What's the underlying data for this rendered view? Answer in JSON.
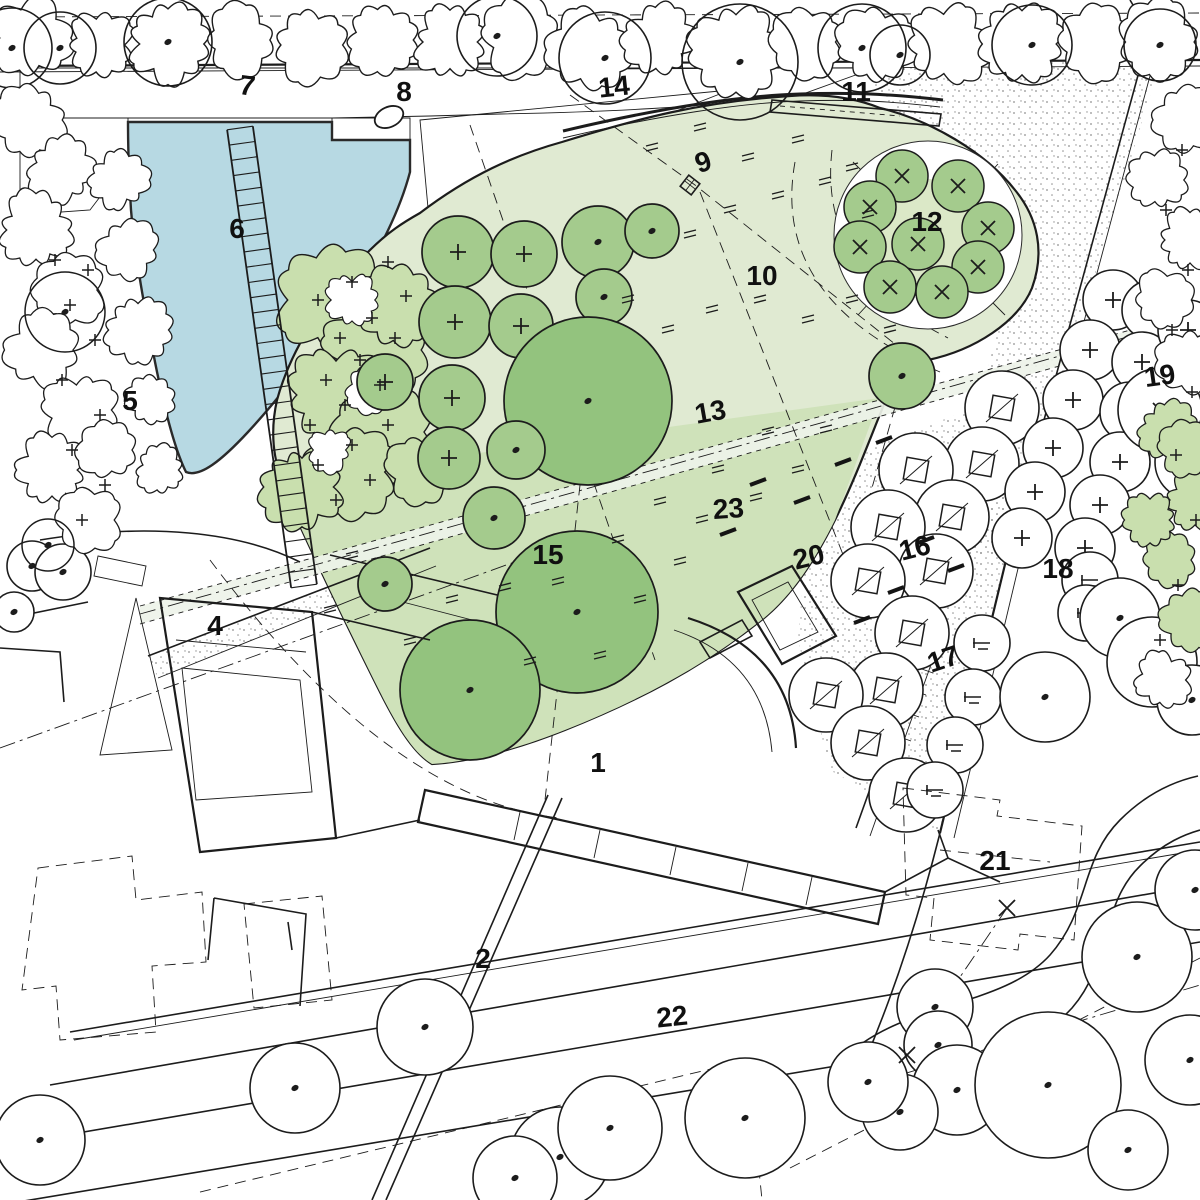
{
  "plan_title": "Landscape site plan",
  "colors": {
    "line": "#1c1c1c",
    "pond": "#b7d9e3",
    "lawn": "#e0ead2",
    "lawn_dark": "#cfe2ba",
    "path_band": "#eef3e9",
    "tree_green": "#a4cb8d",
    "tree_green_dark": "#93c37e",
    "grove_inner": "#dbe8c7",
    "shrub_green": "#c9dfae",
    "paper": "#ffffff",
    "label": "#101010"
  },
  "labels": [
    {
      "t": "1",
      "x": 598,
      "y": 772,
      "r": 0
    },
    {
      "t": "2",
      "x": 483,
      "y": 968,
      "r": 0
    },
    {
      "t": "4",
      "x": 215,
      "y": 635,
      "r": 0
    },
    {
      "t": "5",
      "x": 130,
      "y": 410,
      "r": 0
    },
    {
      "t": "6",
      "x": 237,
      "y": 238,
      "r": 0
    },
    {
      "t": "7",
      "x": 246,
      "y": 95,
      "r": 8
    },
    {
      "t": "8",
      "x": 404,
      "y": 101,
      "r": 0
    },
    {
      "t": "9",
      "x": 706,
      "y": 171,
      "r": -18
    },
    {
      "t": "10",
      "x": 762,
      "y": 285,
      "r": 0
    },
    {
      "t": "11",
      "x": 856,
      "y": 101,
      "r": 0
    },
    {
      "t": "12",
      "x": 927,
      "y": 231,
      "r": 0
    },
    {
      "t": "13",
      "x": 712,
      "y": 421,
      "r": -10
    },
    {
      "t": "14",
      "x": 615,
      "y": 96,
      "r": -6
    },
    {
      "t": "15",
      "x": 548,
      "y": 564,
      "r": 0
    },
    {
      "t": "16",
      "x": 917,
      "y": 557,
      "r": -14
    },
    {
      "t": "17",
      "x": 946,
      "y": 668,
      "r": -18
    },
    {
      "t": "18",
      "x": 1058,
      "y": 578,
      "r": 0
    },
    {
      "t": "19",
      "x": 1161,
      "y": 385,
      "r": -8
    },
    {
      "t": "20",
      "x": 811,
      "y": 566,
      "r": -14
    },
    {
      "t": "21",
      "x": 995,
      "y": 870,
      "r": 0
    },
    {
      "t": "22",
      "x": 673,
      "y": 1026,
      "r": -6
    },
    {
      "t": "23",
      "x": 729,
      "y": 518,
      "r": -4
    }
  ],
  "lawn_trees": [
    [
      458,
      252,
      36,
      "plus"
    ],
    [
      524,
      254,
      33,
      "plus"
    ],
    [
      598,
      242,
      36,
      "dot"
    ],
    [
      652,
      231,
      27,
      "dot"
    ],
    [
      455,
      322,
      36,
      "plus"
    ],
    [
      521,
      326,
      32,
      "plus"
    ],
    [
      604,
      297,
      28,
      "dot"
    ],
    [
      385,
      382,
      28,
      "plus"
    ],
    [
      452,
      398,
      33,
      "plus"
    ],
    [
      588,
      401,
      84,
      "dot"
    ],
    [
      449,
      458,
      31,
      "plus"
    ],
    [
      516,
      450,
      29,
      "dot"
    ],
    [
      494,
      518,
      31,
      "dot"
    ],
    [
      385,
      584,
      27,
      "dot"
    ],
    [
      577,
      612,
      81,
      "dot"
    ],
    [
      470,
      690,
      70,
      "dot"
    ],
    [
      902,
      376,
      33,
      "dot"
    ]
  ],
  "grove_trees": [
    [
      902,
      176
    ],
    [
      958,
      186
    ],
    [
      870,
      207
    ],
    [
      988,
      228
    ],
    [
      860,
      247
    ],
    [
      918,
      244
    ],
    [
      978,
      267
    ],
    [
      890,
      287
    ],
    [
      942,
      292
    ]
  ],
  "bosque_trees": [
    [
      1002,
      408
    ],
    [
      982,
      464
    ],
    [
      916,
      470
    ],
    [
      952,
      517
    ],
    [
      888,
      527
    ],
    [
      936,
      571
    ],
    [
      868,
      581
    ],
    [
      912,
      633
    ],
    [
      886,
      690
    ],
    [
      826,
      695
    ],
    [
      868,
      743
    ],
    [
      906,
      795
    ]
  ],
  "plaza_trees": [
    [
      1113,
      300
    ],
    [
      1152,
      310
    ],
    [
      1090,
      350
    ],
    [
      1142,
      362
    ],
    [
      1188,
      330
    ],
    [
      1073,
      400
    ],
    [
      1130,
      412
    ],
    [
      1190,
      372
    ],
    [
      1053,
      448
    ],
    [
      1120,
      462
    ],
    [
      1035,
      492
    ],
    [
      1100,
      505
    ],
    [
      1022,
      538
    ],
    [
      1085,
      548
    ]
  ],
  "dashed_trees": [
    [
      982,
      643
    ],
    [
      973,
      697
    ],
    [
      955,
      745
    ],
    [
      1090,
      580
    ],
    [
      1086,
      613
    ],
    [
      935,
      790
    ]
  ],
  "right_trees": [
    [
      1160,
      410,
      42,
      "x"
    ],
    [
      1193,
      462,
      38,
      "dot"
    ],
    [
      1120,
      618,
      40,
      "dot"
    ],
    [
      1152,
      662,
      45,
      "dot"
    ],
    [
      1045,
      697,
      45,
      "dot"
    ],
    [
      1192,
      700,
      35,
      "dot"
    ]
  ],
  "bottom_trees": [
    [
      425,
      1027,
      48
    ],
    [
      295,
      1088,
      45
    ],
    [
      40,
      1140,
      45
    ],
    [
      935,
      1007,
      38
    ],
    [
      938,
      1045,
      34
    ],
    [
      957,
      1090,
      45
    ],
    [
      900,
      1112,
      38
    ],
    [
      1048,
      1085,
      73
    ],
    [
      1137,
      957,
      55
    ],
    [
      560,
      1157,
      50
    ],
    [
      515,
      1178,
      42
    ],
    [
      610,
      1128,
      52
    ],
    [
      745,
      1118,
      60
    ],
    [
      868,
      1082,
      40
    ],
    [
      1128,
      1150,
      40
    ],
    [
      1195,
      890,
      40
    ],
    [
      32,
      566,
      25
    ],
    [
      63,
      572,
      28
    ],
    [
      14,
      612,
      20
    ],
    [
      1190,
      1060,
      45
    ]
  ],
  "band_blobs": [
    [
      30,
      38,
      40,
      1
    ],
    [
      100,
      45,
      34,
      2
    ],
    [
      168,
      44,
      40,
      3
    ],
    [
      240,
      40,
      36,
      4
    ],
    [
      310,
      45,
      38,
      5
    ],
    [
      382,
      40,
      34,
      6
    ],
    [
      450,
      42,
      36,
      7
    ],
    [
      520,
      38,
      40,
      8
    ],
    [
      590,
      50,
      42,
      9
    ],
    [
      660,
      40,
      36,
      10
    ],
    [
      736,
      50,
      44,
      11
    ],
    [
      808,
      42,
      36,
      12
    ],
    [
      876,
      46,
      40,
      13
    ],
    [
      948,
      45,
      40,
      14
    ],
    [
      1022,
      44,
      40,
      15
    ],
    [
      1095,
      42,
      38,
      16
    ],
    [
      1160,
      42,
      40,
      17
    ]
  ],
  "band_circles": [
    [
      12,
      48,
      40
    ],
    [
      60,
      48,
      36
    ],
    [
      168,
      42,
      44
    ],
    [
      497,
      36,
      40
    ],
    [
      605,
      58,
      46
    ],
    [
      740,
      62,
      58
    ],
    [
      862,
      48,
      44
    ],
    [
      1032,
      45,
      40
    ],
    [
      1160,
      45,
      36
    ],
    [
      900,
      55,
      30
    ]
  ],
  "left_blobs": [
    [
      30,
      120,
      36,
      21
    ],
    [
      62,
      170,
      34,
      22
    ],
    [
      36,
      230,
      38,
      23
    ],
    [
      70,
      290,
      36,
      24
    ],
    [
      42,
      350,
      38,
      25
    ],
    [
      80,
      410,
      36,
      26
    ],
    [
      52,
      470,
      36,
      27
    ],
    [
      90,
      520,
      32,
      28
    ],
    [
      128,
      250,
      30,
      29
    ],
    [
      118,
      180,
      30,
      30
    ],
    [
      138,
      330,
      32,
      31
    ],
    [
      108,
      450,
      30,
      32
    ],
    [
      150,
      400,
      26,
      33
    ],
    [
      160,
      470,
      24,
      34
    ]
  ],
  "left_circles": [
    [
      65,
      312,
      40
    ],
    [
      48,
      545,
      26
    ]
  ],
  "right_blobs": [
    [
      1185,
      120,
      32,
      41,
      0
    ],
    [
      1158,
      180,
      30,
      42,
      0
    ],
    [
      1190,
      240,
      32,
      43,
      0
    ],
    [
      1163,
      300,
      30,
      44,
      0
    ],
    [
      1190,
      360,
      32,
      45,
      0
    ],
    [
      1168,
      430,
      30,
      46,
      1
    ],
    [
      1195,
      500,
      30,
      47,
      1
    ],
    [
      1170,
      560,
      28,
      48,
      1
    ],
    [
      1190,
      620,
      30,
      49,
      1
    ],
    [
      1163,
      680,
      28,
      50,
      0
    ],
    [
      1150,
      520,
      26,
      51,
      1
    ],
    [
      1185,
      450,
      28,
      52,
      1
    ]
  ],
  "shrub_blobs": [
    [
      330,
      300,
      55,
      61
    ],
    [
      372,
      350,
      50,
      62
    ],
    [
      336,
      395,
      48,
      63
    ],
    [
      386,
      432,
      52,
      64
    ],
    [
      352,
      472,
      45,
      65
    ],
    [
      398,
      308,
      40,
      66
    ],
    [
      302,
      487,
      40,
      67
    ],
    [
      420,
      470,
      34,
      68
    ]
  ],
  "shrub_white_blobs": [
    [
      352,
      300,
      26,
      71
    ],
    [
      368,
      390,
      24,
      72
    ],
    [
      330,
      450,
      22,
      73
    ]
  ],
  "shrub_plus": [
    [
      318,
      300
    ],
    [
      352,
      282
    ],
    [
      388,
      262
    ],
    [
      340,
      338
    ],
    [
      372,
      318
    ],
    [
      406,
      296
    ],
    [
      326,
      380
    ],
    [
      360,
      360
    ],
    [
      395,
      338
    ],
    [
      310,
      425
    ],
    [
      345,
      405
    ],
    [
      380,
      385
    ],
    [
      318,
      465
    ],
    [
      352,
      445
    ],
    [
      388,
      425
    ],
    [
      336,
      500
    ],
    [
      370,
      480
    ]
  ],
  "left_plus": [
    [
      70,
      305
    ],
    [
      95,
      340
    ],
    [
      62,
      380
    ],
    [
      100,
      415
    ],
    [
      72,
      450
    ],
    [
      105,
      485
    ],
    [
      82,
      520
    ],
    [
      55,
      260
    ],
    [
      88,
      270
    ]
  ],
  "right_plus": [
    [
      1182,
      150
    ],
    [
      1166,
      210
    ],
    [
      1188,
      270
    ],
    [
      1172,
      330
    ],
    [
      1192,
      392
    ],
    [
      1176,
      455
    ],
    [
      1196,
      520
    ],
    [
      1178,
      585
    ],
    [
      1160,
      640
    ]
  ],
  "tufts": [
    [
      652,
      148
    ],
    [
      700,
      128
    ],
    [
      748,
      158
    ],
    [
      798,
      140
    ],
    [
      852,
      168
    ],
    [
      690,
      235
    ],
    [
      730,
      210
    ],
    [
      778,
      196
    ],
    [
      825,
      182
    ],
    [
      868,
      215
    ],
    [
      628,
      300
    ],
    [
      668,
      330
    ],
    [
      712,
      310
    ],
    [
      760,
      300
    ],
    [
      808,
      320
    ],
    [
      852,
      300
    ],
    [
      890,
      330
    ],
    [
      352,
      556
    ],
    [
      330,
      610
    ],
    [
      410,
      642
    ],
    [
      452,
      600
    ],
    [
      530,
      662
    ],
    [
      600,
      656
    ],
    [
      640,
      600
    ],
    [
      680,
      562
    ],
    [
      702,
      520
    ],
    [
      756,
      498
    ],
    [
      798,
      470
    ],
    [
      826,
      430
    ],
    [
      768,
      432
    ],
    [
      718,
      470
    ],
    [
      660,
      502
    ],
    [
      618,
      540
    ],
    [
      558,
      582
    ],
    [
      505,
      588
    ]
  ],
  "slope_marks": [
    [
      758,
      482
    ],
    [
      802,
      500
    ],
    [
      728,
      532
    ],
    [
      843,
      462
    ],
    [
      884,
      440
    ],
    [
      956,
      568
    ],
    [
      926,
      540
    ],
    [
      896,
      590
    ],
    [
      862,
      620
    ]
  ],
  "x_marks": [
    [
      1007,
      908
    ],
    [
      907,
      1055
    ]
  ],
  "stairs": {
    "x1": 240,
    "y1": 128,
    "x2": 304,
    "y2": 586,
    "w": 26,
    "steps": 30
  },
  "allee": {
    "x1": 930,
    "y1": 622,
    "x2": 856,
    "y2": 828,
    "w": 14,
    "steps": 7
  }
}
